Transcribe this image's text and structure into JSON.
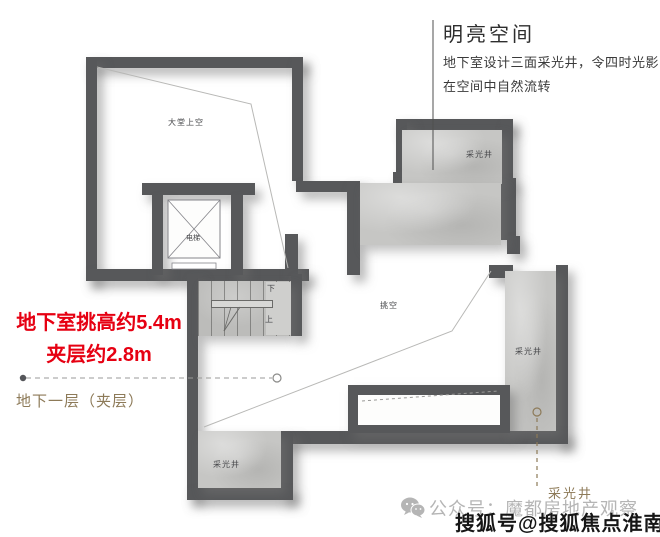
{
  "callout": {
    "title": "明亮空间",
    "desc_line1": "地下室设计三面采光井，令四时光影",
    "desc_line2": "在空间中自然流转"
  },
  "specs": {
    "height_line": "地下室挑高约5.4m",
    "mezzanine_line": "夹层约2.8m"
  },
  "floor_label": "地下一层（夹层）",
  "plan_labels": {
    "lobby_void": "大堂上空",
    "elevator": "电梯",
    "stair_down": "下",
    "stair_up": "上",
    "double_height_void": "挑空",
    "lightwell_top": "采光井",
    "lightwell_right": "采光井",
    "lightwell_bottom_left": "采光井",
    "lightwell_callout": "采光井"
  },
  "watermarks": {
    "wechat_account": "公众号：魔都房地产观察",
    "sohu_account": "搜狐号@搜狐焦点淮南站"
  },
  "icons": {
    "wechat": "wechat-icon"
  },
  "colors": {
    "accent_red": "#e60012",
    "label_brown": "#8d7a58",
    "wall_dark": "#57585a",
    "marble": "#c6c6c4",
    "watermark_gray": "#b5b5b5",
    "watermark_black": "#161616"
  }
}
